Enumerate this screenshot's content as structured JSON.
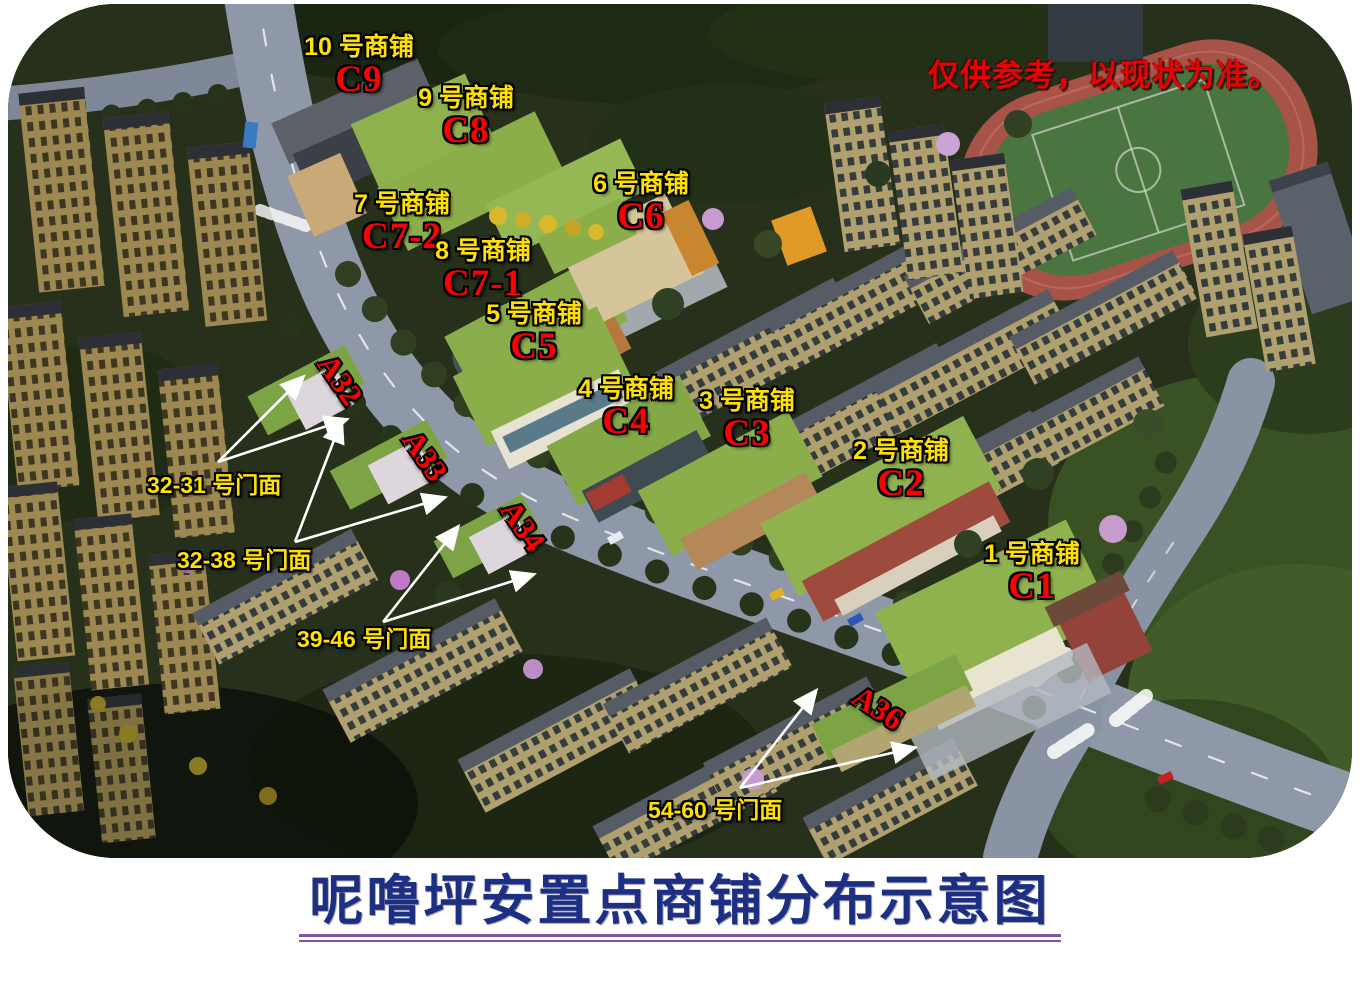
{
  "disclaimer": "仅供参考，以现状为准。",
  "title": "呢噜坪安置点商铺分布示意图",
  "colors": {
    "shop_name": "#ffe100",
    "shop_code": "#ff0000",
    "zone_code": "#ff0000",
    "storefront": "#ffe100",
    "disclaimer": "#ee0000",
    "title": "#1d2f82",
    "underline": "#8055a0",
    "arrow": "#ffffff"
  },
  "shops": [
    {
      "name": "10 号商铺",
      "code": "C9"
    },
    {
      "name": "9 号商铺",
      "code": "C8"
    },
    {
      "name": "6 号商铺",
      "code": "C6"
    },
    {
      "name": "7 号商铺",
      "code": "C7-2"
    },
    {
      "name": "8 号商铺",
      "code": "C7-1"
    },
    {
      "name": "5 号商铺",
      "code": "C5"
    },
    {
      "name": "4 号商铺",
      "code": "C4"
    },
    {
      "name": "3 号商铺",
      "code": "C3"
    },
    {
      "name": "2 号商铺",
      "code": "C2"
    },
    {
      "name": "1 号商铺",
      "code": "C1"
    }
  ],
  "zones": [
    {
      "code": "A32"
    },
    {
      "code": "A33"
    },
    {
      "code": "A34"
    },
    {
      "code": "A36"
    }
  ],
  "storefronts": [
    {
      "label": "32-31 号门面"
    },
    {
      "label": "32-38 号门面"
    },
    {
      "label": "39-46 号门面"
    },
    {
      "label": "54-60 号门面"
    }
  ]
}
